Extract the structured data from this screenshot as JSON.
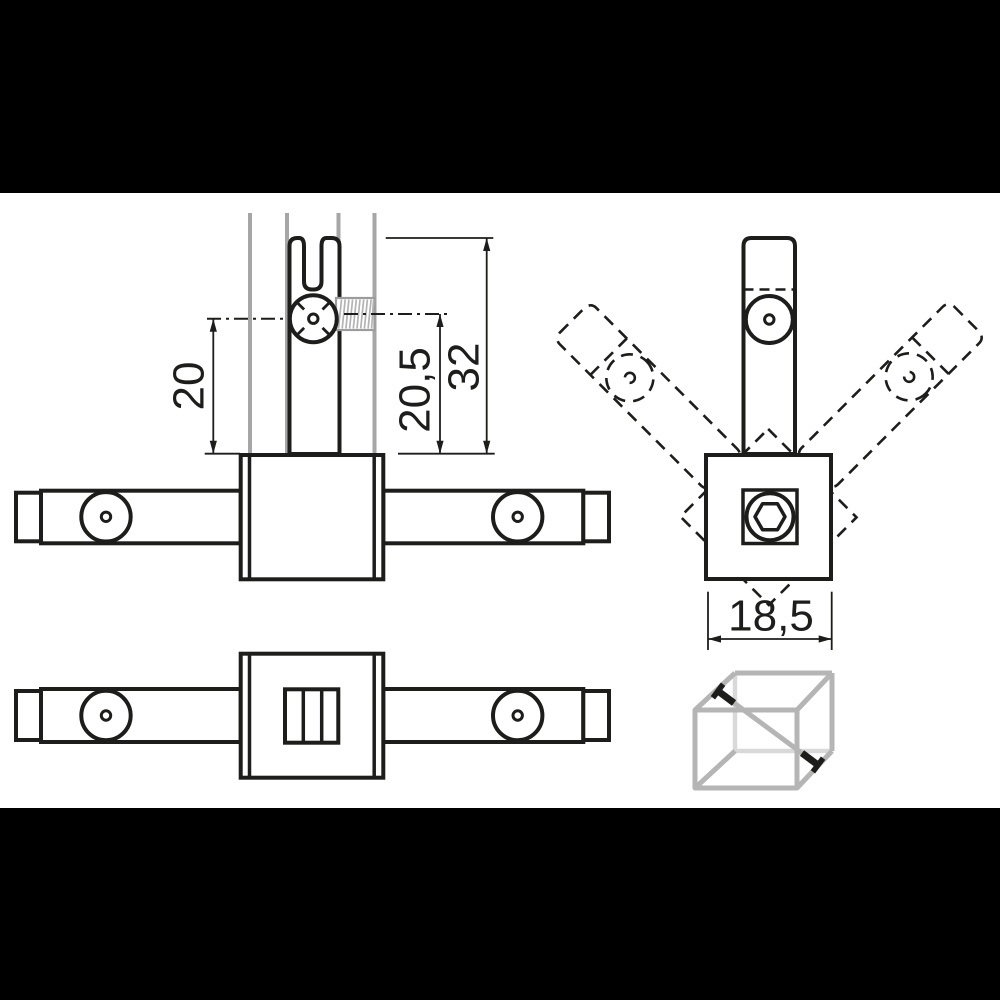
{
  "drawing": {
    "dimensions": {
      "pivot_to_base": "20",
      "stud_axis_to_base": "20,5",
      "fork_top_to_base": "32",
      "block_width": "18,5"
    },
    "icons": {
      "cube": "cube-diagonal-brace-icon"
    },
    "colors": {
      "line": "#1d1d1b",
      "dimension_line": "#1d1d1b",
      "tube_gray": "#a6a6a6",
      "thread_gray": "#b3b3b3",
      "thread_outline_gray": "#9c9c9c",
      "cube_edge_gray": "#b5b5b5",
      "cube_hidden_edge_gray": "#d9d9d9",
      "letterbox": "#000000",
      "background": "#ffffff"
    }
  }
}
